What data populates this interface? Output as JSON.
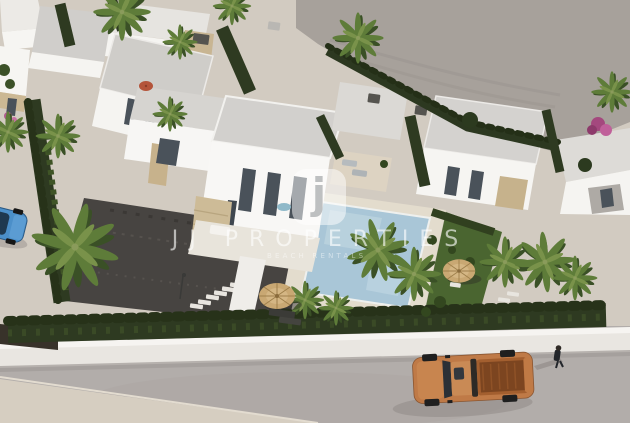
{
  "meta": {
    "type": "architectural-3d-render",
    "view": "aerial",
    "description": "Aerial render of a modern white-villa residential development with flat grey roofs, travertine stone accents, cypress hedges, palm trees, swimming pool, gravel driveway, perimeter wall and a street with an orange pickup truck, a pedestrian and a parked blue car"
  },
  "watermark": {
    "logo_glyph": "j",
    "title": "JJ PROPERTIES",
    "tagline": "BEACH RENTALS"
  },
  "scene": {
    "objects": [
      "white-villas",
      "main-villa",
      "swimming-pool",
      "pool-deck",
      "lawn",
      "gravel-driveway",
      "stepping-stones",
      "straw-parasols",
      "palm-trees",
      "cypress-hedges",
      "perimeter-wall",
      "street",
      "sidewalk",
      "orange-pickup-truck",
      "pedestrian",
      "blue-car",
      "empty-plot",
      "bougainvillea",
      "street-lamp",
      "sun-loungers"
    ]
  },
  "palette": {
    "villa_white": "#f7f6f4",
    "roof_grey": "#d2d0cd",
    "stone_tan": "#cdbb97",
    "hedge_green": "#2e3a21",
    "lawn_green": "#4a6530",
    "pool_blue": "#a9c6d7",
    "deck_beige": "#e3dccd",
    "gravel_dark": "#474441",
    "road_grey": "#b2adaa",
    "plot_taupe": "#a7a19b",
    "sidewalk_beige": "#d6cec1",
    "truck_orange": "#bf7a47",
    "car_blue": "#4b8fc9",
    "parasol_straw": "#c9a873",
    "window_dark": "#4a525a",
    "watermark_white": "#ffffff"
  }
}
